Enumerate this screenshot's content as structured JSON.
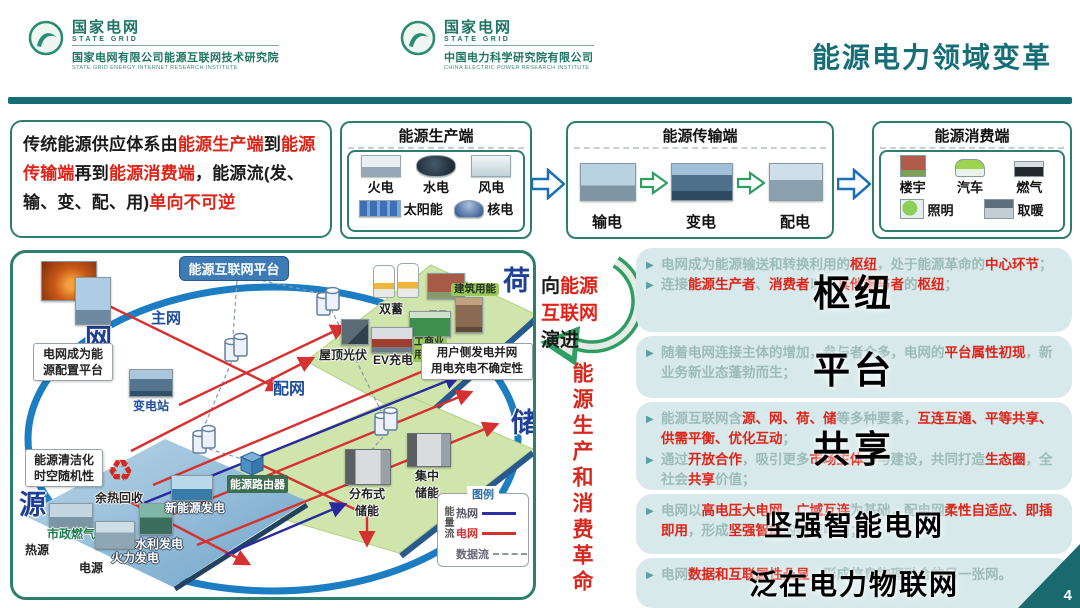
{
  "header": {
    "title": "能源电力领域变革",
    "logos": [
      {
        "cn": "国家电网",
        "en": "STATE GRID",
        "org_cn": "国家电网有限公司能源互联网技术研究院",
        "org_en": "STATE GRID ENERGY INTERNET RESEARCH INSTITUTE"
      },
      {
        "cn": "国家电网",
        "en": "STATE GRID",
        "org_cn": "中国电力科学研究院有限公司",
        "org_en": "CHINA ELECTRIC POWER RESEARCH INSTITUTE"
      }
    ]
  },
  "icons": {
    "bullet": "▶",
    "recycle": "♻"
  },
  "intro": {
    "segments": [
      {
        "text": "传统能源供应体系由",
        "c": "k"
      },
      {
        "text": "能源生产端",
        "c": "r"
      },
      {
        "text": "到",
        "c": "k"
      },
      {
        "text": "能源传输端",
        "c": "r"
      },
      {
        "text": "再到",
        "c": "k"
      },
      {
        "text": "能源消费端",
        "c": "r"
      },
      {
        "text": "，能源流(发、输、变、配、用)",
        "c": "k"
      },
      {
        "text": "单向不可逆",
        "c": "r"
      }
    ]
  },
  "flow": {
    "production": {
      "title": "能源生产端",
      "items": [
        {
          "label": "火电"
        },
        {
          "label": "水电"
        },
        {
          "label": "风电"
        },
        {
          "label": "太阳能"
        },
        {
          "label": "核电"
        }
      ]
    },
    "transmission": {
      "title": "能源传输端",
      "items": [
        {
          "label": "输电"
        },
        {
          "label": "变电"
        },
        {
          "label": "配电"
        }
      ]
    },
    "consumption": {
      "title": "能源消费端",
      "items": [
        {
          "label": "楼宇"
        },
        {
          "label": "汽车"
        },
        {
          "label": "燃气"
        },
        {
          "label": "照明"
        },
        {
          "label": "取暖"
        }
      ]
    }
  },
  "diagram": {
    "platform": "能源互联网平台",
    "corners": {
      "grid": "网",
      "load": "荷",
      "storage": "储",
      "source": "源"
    },
    "grid": {
      "main_grid": "主网",
      "substation": "变电站",
      "dist_grid": "配网",
      "callout": "电网成为能\n源配置平台"
    },
    "load": {
      "dual_storage": "双蓄",
      "building": "建筑用能",
      "resident": "居民\n用能",
      "industry": "工商业\n用能",
      "rooftop_pv": "屋顶光伏",
      "ev_charging": "EV充电",
      "callout": "用户侧发电并网\n用电充电不确定性"
    },
    "storage": {
      "distributed": "分布式\n储能",
      "centralized": "集中\n储能"
    },
    "source": {
      "callout": "能源清洁化\n时空随机性",
      "waste_heat": "余热回收",
      "city_gas": "市政燃气",
      "heat_source": "热源",
      "power_source": "电源",
      "thermal_gen": "火力发电",
      "hydro_gen": "水利发电",
      "new_energy_gen": "新能源发电",
      "energy_router": "能源路由器"
    },
    "legend": {
      "title": "图例",
      "flow_group": "能量流",
      "heat_net": "热网",
      "power_net": "电网",
      "data_flow": "数据流"
    }
  },
  "middle": {
    "evolve_lines": [
      [
        {
          "text": "向",
          "c": "k"
        },
        {
          "text": "能源",
          "c": "r"
        }
      ],
      [
        {
          "text": "互联网",
          "c": "r"
        }
      ],
      [
        {
          "text": "演进",
          "c": "k"
        }
      ]
    ],
    "revolution": "能源生产和消费革命"
  },
  "right_panel": {
    "boxes": [
      {
        "overlay": "枢纽",
        "bullets": [
          [
            {
              "text": "电网成为能源输送和转换利用的",
              "c": "g"
            },
            {
              "text": "枢纽",
              "c": "r"
            },
            {
              "text": "，处于能源革命的",
              "c": "g"
            },
            {
              "text": "中心环节",
              "c": "r"
            },
            {
              "text": "；",
              "c": "g"
            }
          ],
          [
            {
              "text": "连接",
              "c": "g"
            },
            {
              "text": "能源生产者",
              "c": "r"
            },
            {
              "text": "、",
              "c": "g"
            },
            {
              "text": "消费者",
              "c": "r"
            },
            {
              "text": "以及",
              "c": "g"
            },
            {
              "text": "其他参与者",
              "c": "r"
            },
            {
              "text": "的",
              "c": "g"
            },
            {
              "text": "枢纽",
              "c": "r"
            },
            {
              "text": "；",
              "c": "g"
            }
          ]
        ]
      },
      {
        "overlay": "平台",
        "bullets": [
          [
            {
              "text": "随着电网连接主体的增加，参与者众多，电网的",
              "c": "g"
            },
            {
              "text": "平台属性初现",
              "c": "r"
            },
            {
              "text": "，新业务新业态蓬勃而生；",
              "c": "g"
            }
          ]
        ]
      },
      {
        "overlay": "共享",
        "bullets": [
          [
            {
              "text": "能源互联网含",
              "c": "g"
            },
            {
              "text": "源、网、荷、储",
              "c": "r"
            },
            {
              "text": "等多种要素，",
              "c": "g"
            },
            {
              "text": "互连互通、平等共享、供需平衡、优化互动",
              "c": "r"
            },
            {
              "text": "；",
              "c": "g"
            }
          ],
          [
            {
              "text": "通过",
              "c": "g"
            },
            {
              "text": "开放合作",
              "c": "r"
            },
            {
              "text": "，吸引更多",
              "c": "g"
            },
            {
              "text": "市场主体",
              "c": "r"
            },
            {
              "text": "参与建设，共同打造",
              "c": "g"
            },
            {
              "text": "生态圈",
              "c": "r"
            },
            {
              "text": "，全社会",
              "c": "g"
            },
            {
              "text": "共享",
              "c": "r"
            },
            {
              "text": "价值；",
              "c": "g"
            }
          ]
        ]
      },
      {
        "overlay": "坚强智能电网",
        "bullets": [
          [
            {
              "text": "电网以",
              "c": "g"
            },
            {
              "text": "高电压大电网、广域互连",
              "c": "r"
            },
            {
              "text": "为基础，配电网",
              "c": "g"
            },
            {
              "text": "柔性自适应、即插即用",
              "c": "r"
            },
            {
              "text": "，形成",
              "c": "g"
            },
            {
              "text": "坚强智能",
              "c": "r"
            },
            {
              "text": "的物理电网；",
              "c": "g"
            }
          ]
        ]
      },
      {
        "overlay": "泛在电力物联网",
        "bullets": [
          [
            {
              "text": "电网",
              "c": "g"
            },
            {
              "text": "数据和互联属性凸显",
              "c": "r"
            },
            {
              "text": "，形成信息物理融合的另一张网。",
              "c": "g"
            }
          ]
        ]
      }
    ]
  },
  "page_number": "4"
}
